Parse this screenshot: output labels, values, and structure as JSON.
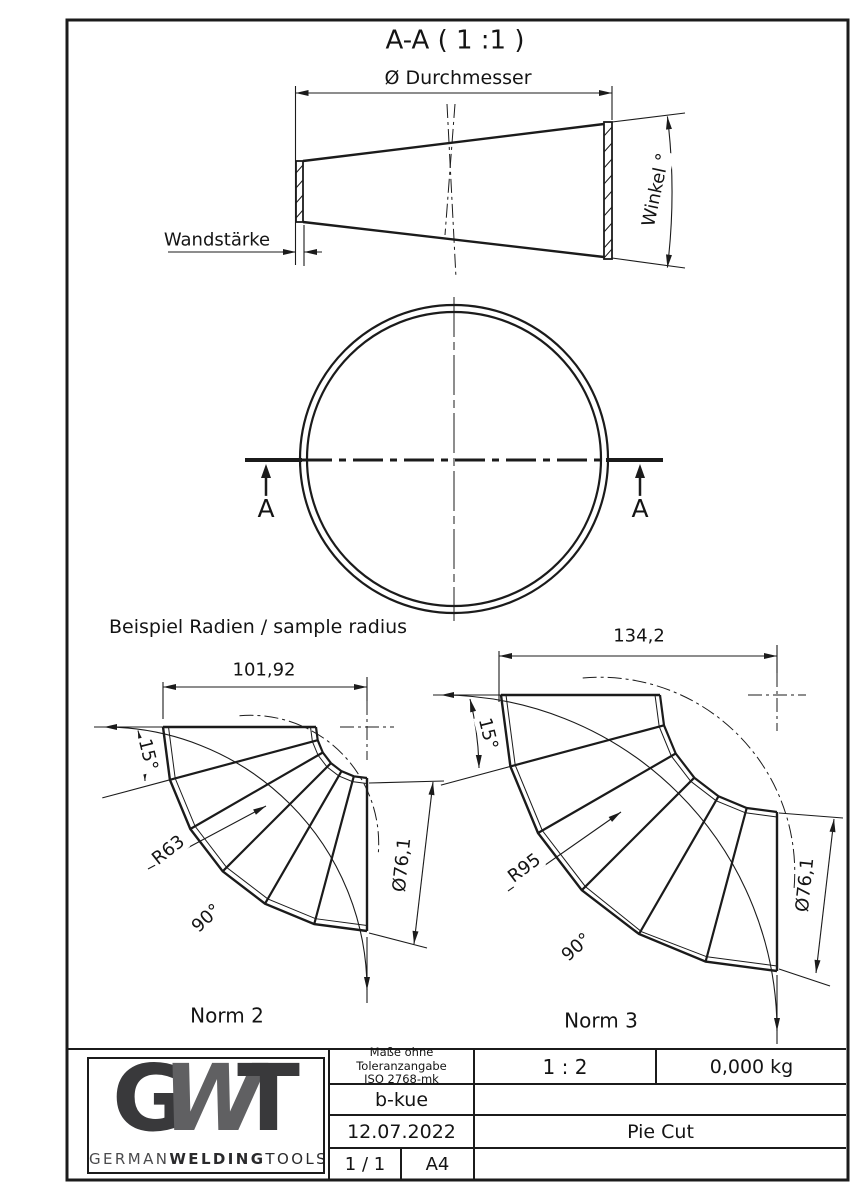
{
  "drawing": {
    "section_title": "A-A ( 1 :1 )",
    "cone": {
      "diameter_label": "Ø Durchmesser",
      "wall_label": "Wandstärke",
      "angle_label": "Winkel °"
    },
    "circle": {
      "cut_label_left": "A",
      "cut_label_right": "A"
    },
    "samples_heading": "Beispiel Radien / sample radius",
    "norm2": {
      "name": "Norm 2",
      "width": "101,92",
      "segment_angle": "15°",
      "radius": "R63",
      "sweep": "90°",
      "pipe_diameter": "Ø76,1"
    },
    "norm3": {
      "name": "Norm 3",
      "width": "134,2",
      "segment_angle": "15°",
      "radius": "R95",
      "sweep": "90°",
      "pipe_diameter": "Ø76,1"
    }
  },
  "title_block": {
    "tolerance_line1": "Maße ohne Toleranzangabe",
    "tolerance_line2": "ISO 2768-mk",
    "scale": "1 : 2",
    "weight": "0,000 kg",
    "created_by": "b-kue",
    "date": "12.07.2022",
    "part_name": "Pie Cut",
    "sheet": "1 / 1",
    "paper_format": "A4",
    "logo": {
      "g": "G",
      "w": "W",
      "t": "T",
      "brand_regular": "GERMAN",
      "brand_bold": "WELDING",
      "brand_end": "TOOLS"
    }
  },
  "colors": {
    "line": "#1b1b1b",
    "logo_dark": "#39393b",
    "logo_mid": "#606062"
  }
}
